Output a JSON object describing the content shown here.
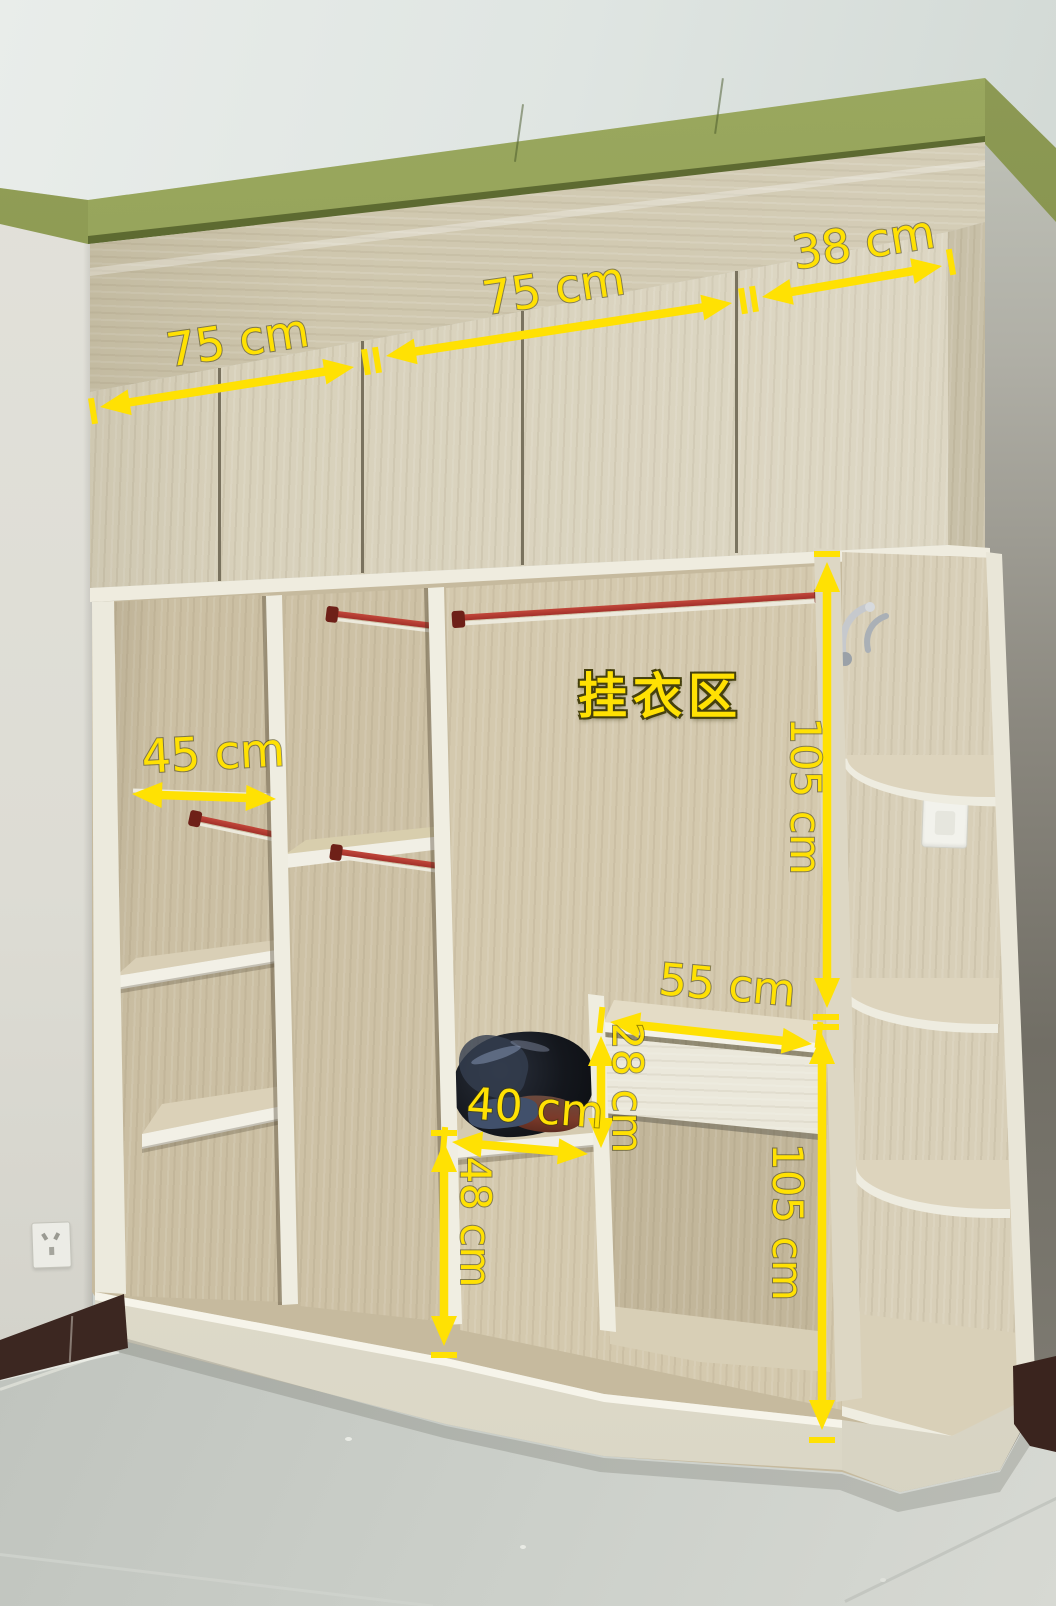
{
  "area_label": {
    "text": "挂衣区"
  },
  "measurements": [
    {
      "name": "top-cabinet-left-width",
      "text": "75 cm",
      "arrow": {
        "x1": 100,
        "y1": 407,
        "x2": 354,
        "y2": 367
      },
      "ticks": [
        [
          93,
          411
        ],
        [
          366,
          362
        ],
        [
          377,
          360
        ]
      ],
      "label": {
        "x": 240,
        "y": 356,
        "rot": -8.5,
        "size": 46
      }
    },
    {
      "name": "top-cabinet-middle-width",
      "text": "75 cm",
      "arrow": {
        "x1": 386,
        "y1": 356,
        "x2": 732,
        "y2": 303
      },
      "ticks": [
        [
          743,
          301
        ],
        [
          754,
          299
        ]
      ],
      "label": {
        "x": 556,
        "y": 304,
        "rot": -8.5,
        "size": 46
      }
    },
    {
      "name": "top-cabinet-right-width",
      "text": "38 cm",
      "arrow": {
        "x1": 762,
        "y1": 297,
        "x2": 942,
        "y2": 266
      },
      "ticks": [
        [
          951,
          262
        ]
      ],
      "label": {
        "x": 866,
        "y": 258,
        "rot": -9,
        "size": 46
      }
    },
    {
      "name": "left-column-width",
      "text": "45 cm",
      "arrow": {
        "x1": 132,
        "y1": 794,
        "x2": 276,
        "y2": 799
      },
      "ticks": [],
      "label": {
        "x": 214,
        "y": 769,
        "rot": -3,
        "size": 46
      }
    },
    {
      "name": "hanging-area-height",
      "text": "105 cm",
      "arrow": {
        "x1": 827,
        "y1": 562,
        "x2": 827,
        "y2": 1008
      },
      "ticks": [
        [
          827,
          554
        ],
        [
          826,
          1017
        ],
        [
          826,
          1027
        ]
      ],
      "label": {
        "x": 791,
        "y": 796,
        "rot": 90,
        "size": 42
      }
    },
    {
      "name": "dressing-table-width",
      "text": "55 cm",
      "arrow": {
        "x1": 610,
        "y1": 1022,
        "x2": 812,
        "y2": 1044
      },
      "ticks": [
        [
          601,
          1020
        ],
        [
          819,
          1035
        ]
      ],
      "label": {
        "x": 726,
        "y": 1000,
        "rot": 5,
        "size": 44
      }
    },
    {
      "name": "dressing-table-apron-height",
      "text": "28 cm",
      "arrow": {
        "x1": 601,
        "y1": 1036,
        "x2": 601,
        "y2": 1148
      },
      "ticks": [],
      "label": {
        "x": 613,
        "y": 1088,
        "rot": 90,
        "size": 42
      }
    },
    {
      "name": "shoe-shelf-width",
      "text": "40 cm",
      "arrow": {
        "x1": 452,
        "y1": 1142,
        "x2": 588,
        "y2": 1154
      },
      "ticks": [
        [
          444,
          1140
        ]
      ],
      "label": {
        "x": 534,
        "y": 1123,
        "rot": 4,
        "size": 44
      }
    },
    {
      "name": "bottom-compartment-height",
      "text": "48 cm",
      "arrow": {
        "x1": 444,
        "y1": 1142,
        "x2": 444,
        "y2": 1346
      },
      "ticks": [
        [
          444,
          1133
        ],
        [
          444,
          1355
        ]
      ],
      "label": {
        "x": 461,
        "y": 1222,
        "rot": 90,
        "size": 42
      }
    },
    {
      "name": "lower-right-height",
      "text": "105 cm",
      "arrow": {
        "x1": 822,
        "y1": 1034,
        "x2": 822,
        "y2": 1430
      },
      "ticks": [
        [
          822,
          1440
        ]
      ],
      "label": {
        "x": 773,
        "y": 1222,
        "rot": 90,
        "size": 42
      }
    }
  ],
  "colors": {
    "annotation_yellow": "#ffe103",
    "molding_green": "#7f8e49",
    "cabinet_wood": "#d6cfb8",
    "interior_wood": "#d0c4a8",
    "trim_white": "#f1efe5",
    "rod_red": "#b23b2e",
    "baseboard_brown": "#3c2721",
    "floor_gray": "#c3c7c1"
  }
}
